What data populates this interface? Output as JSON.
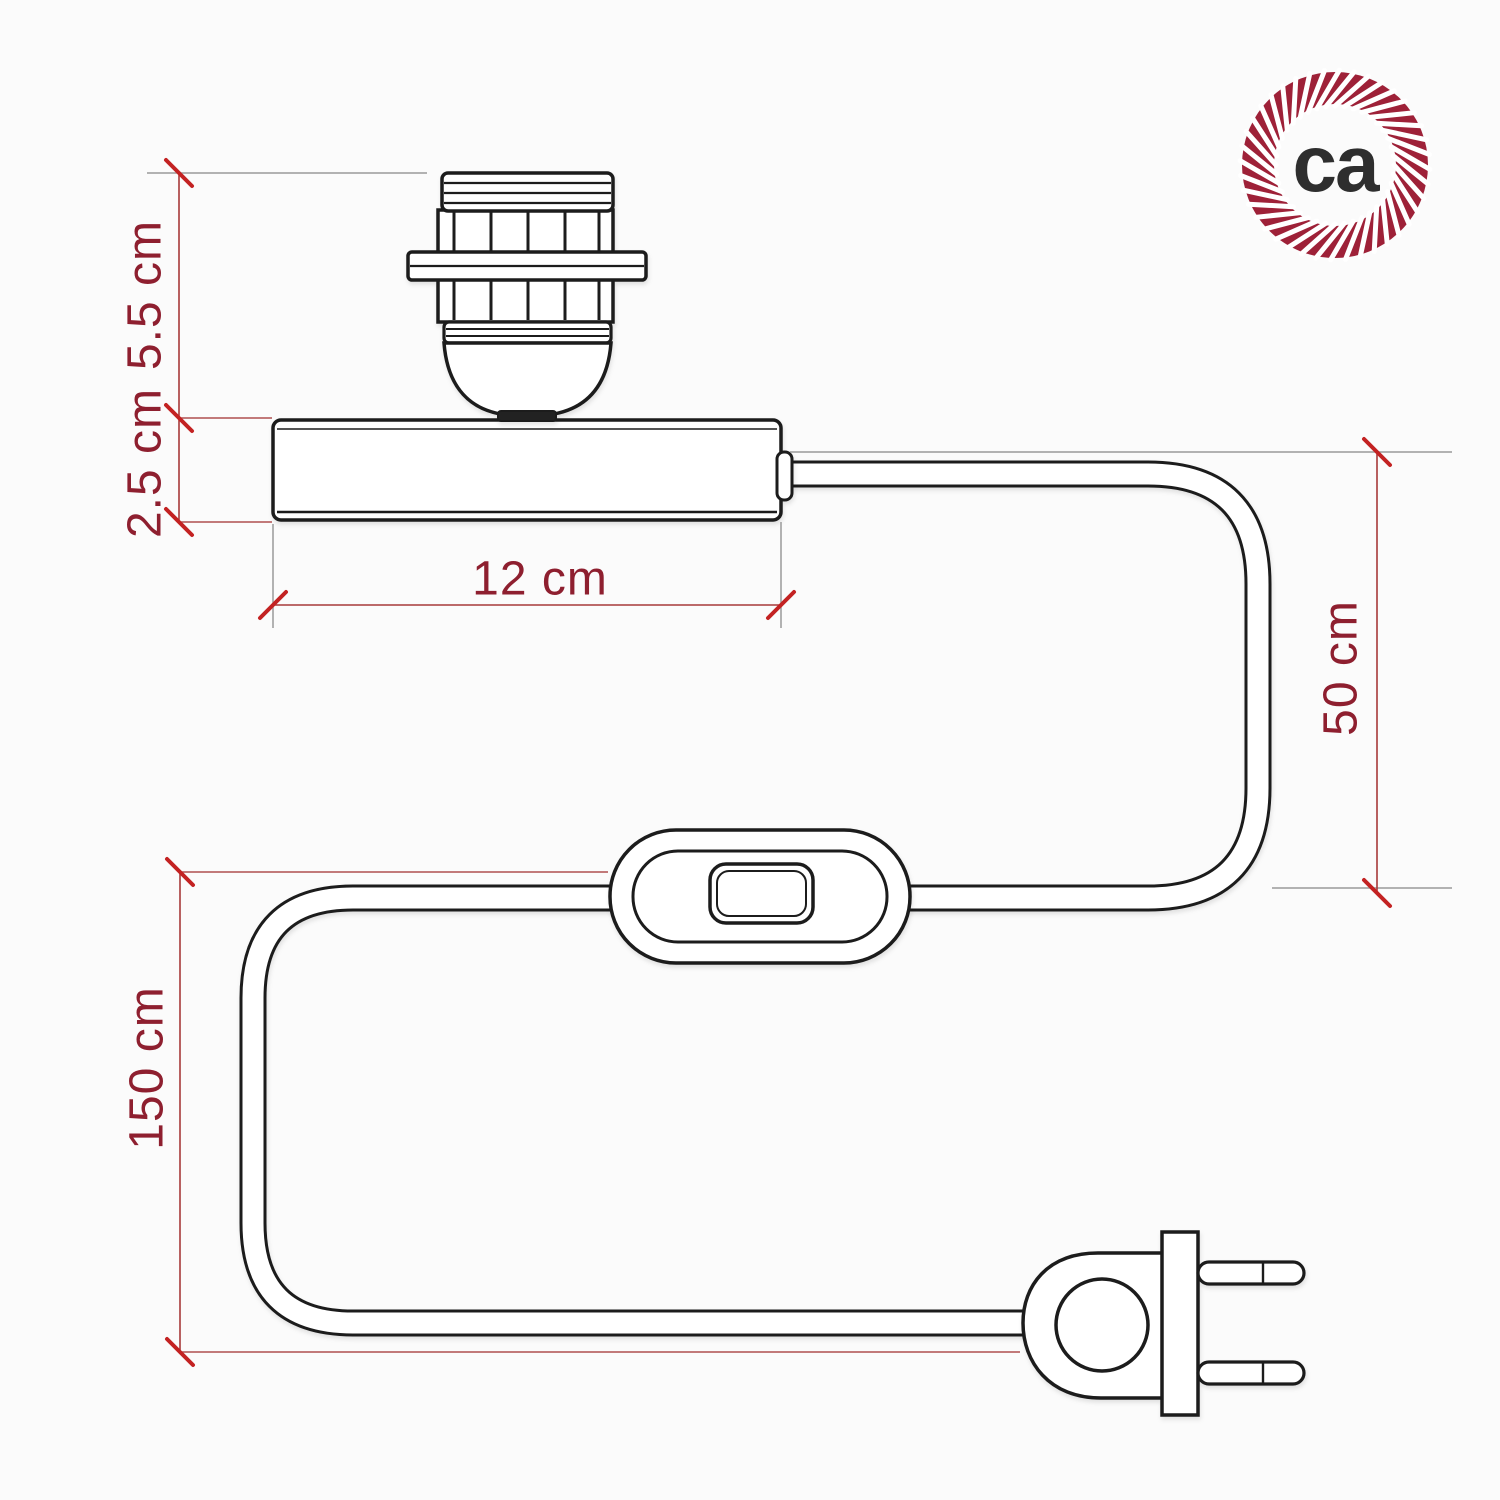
{
  "image": {
    "description": "Technical dimension diagram of a table lamp fitting: E27 socket on cylindrical base, power cord with inline switch and two-pin plug",
    "background": "#fbfbfb"
  },
  "colors": {
    "ink": "#1c1c1c",
    "label": "#8e1f2f",
    "dimension": "#a83a3a",
    "tick": "#c32222",
    "extension": "#9a9a9a",
    "extension_red": "#b05050",
    "logo_ring": "#9e2138",
    "logo_text": "#2e2e2e"
  },
  "labels": {
    "socket_height": "5.5 cm",
    "base_height": "2.5 cm",
    "base_width": "12 cm",
    "upper_cable_length": "50 cm",
    "lower_cable_length": "150 cm"
  },
  "logo": {
    "text": "ca"
  }
}
